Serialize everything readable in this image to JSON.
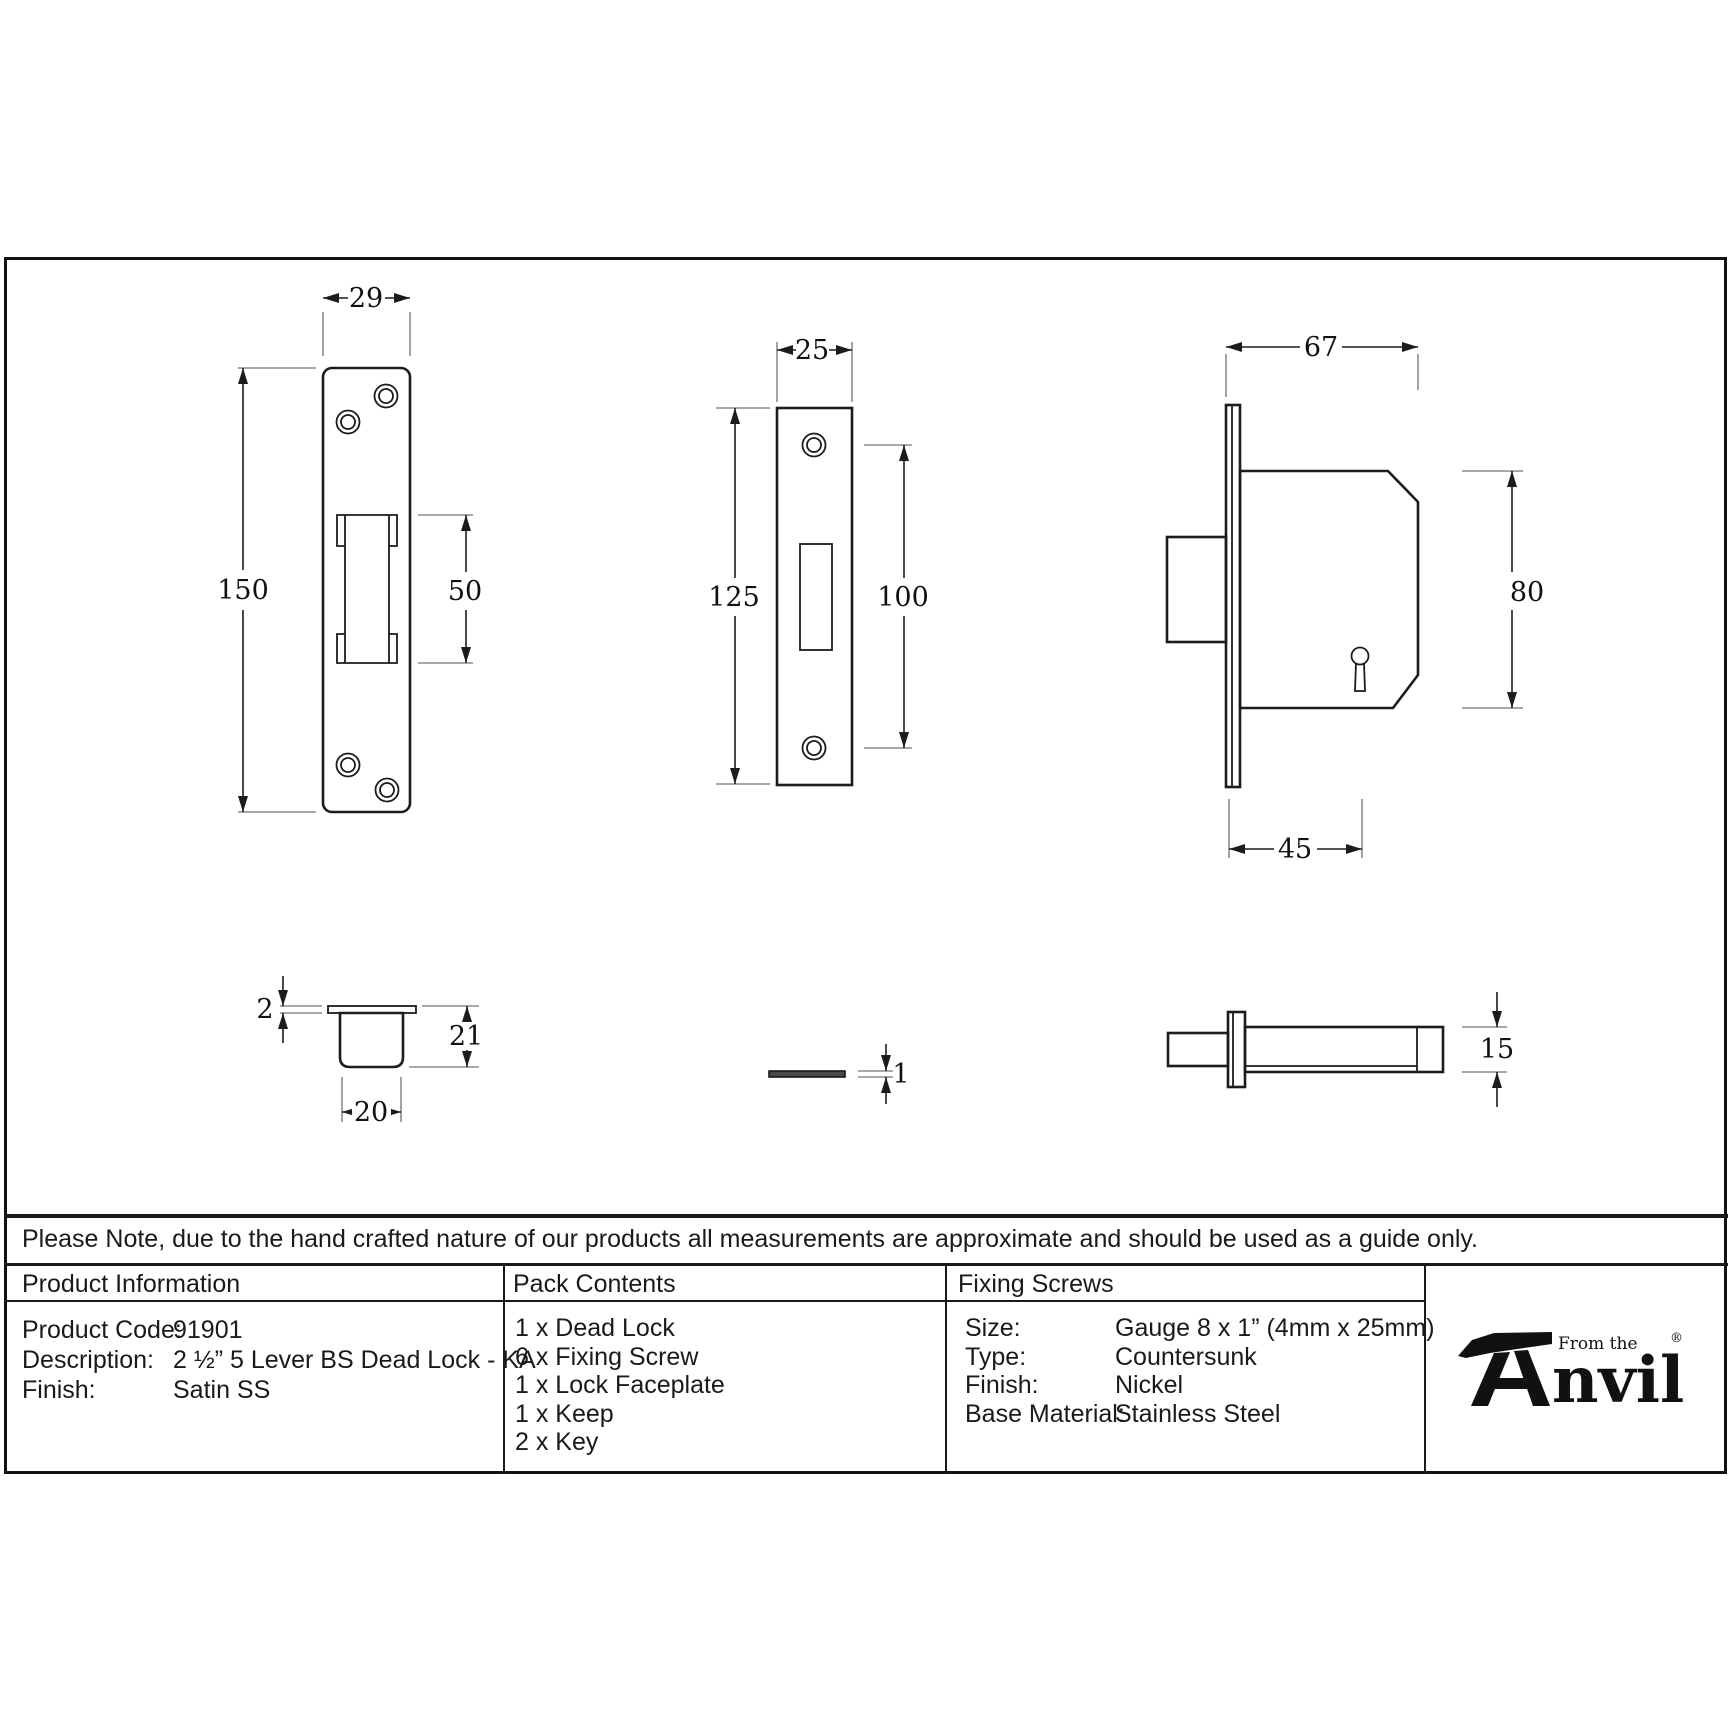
{
  "note": "Please Note, due to the hand crafted nature of our products all measurements are approximate and should be used as a guide only.",
  "colors": {
    "line": "#1c1c1c",
    "background": "#ffffff",
    "text": "#1a1a1a"
  },
  "drawings": {
    "faceplate_front": {
      "width": "29",
      "height": "150",
      "slot_height": "50"
    },
    "keep_front": {
      "width": "25",
      "height": "125",
      "hole_spacing": "100"
    },
    "lock_side": {
      "width": "67",
      "height": "80",
      "backset": "45"
    },
    "keep_box": {
      "flange_thickness": "2",
      "depth": "21",
      "width": "20"
    },
    "faceplate_side": {
      "thickness": "1"
    },
    "bolt_side": {
      "height": "15"
    }
  },
  "table": {
    "product_information": {
      "header": "Product Information",
      "rows": [
        {
          "label": "Product Code:",
          "value": "91901"
        },
        {
          "label": "Description:",
          "value": "2 ½” 5 Lever BS Dead Lock - KA"
        },
        {
          "label": "Finish:",
          "value": "Satin SS"
        }
      ]
    },
    "pack_contents": {
      "header": "Pack Contents",
      "items": [
        "1 x Dead Lock",
        "6 x Fixing Screw",
        "1 x Lock Faceplate",
        "1 x Keep",
        "2 x Key"
      ]
    },
    "fixing_screws": {
      "header": "Fixing Screws",
      "rows": [
        {
          "label": "Size:",
          "value": "Gauge 8 x 1” (4mm x 25mm)"
        },
        {
          "label": "Type:",
          "value": "Countersunk"
        },
        {
          "label": "Finish:",
          "value": "Nickel"
        },
        {
          "label": "Base Material:",
          "value": "Stainless Steel"
        }
      ]
    }
  },
  "logo": {
    "icon": "anvil-icon",
    "prefix": "From the",
    "brand_suffix": "nvil",
    "registered": "®"
  }
}
